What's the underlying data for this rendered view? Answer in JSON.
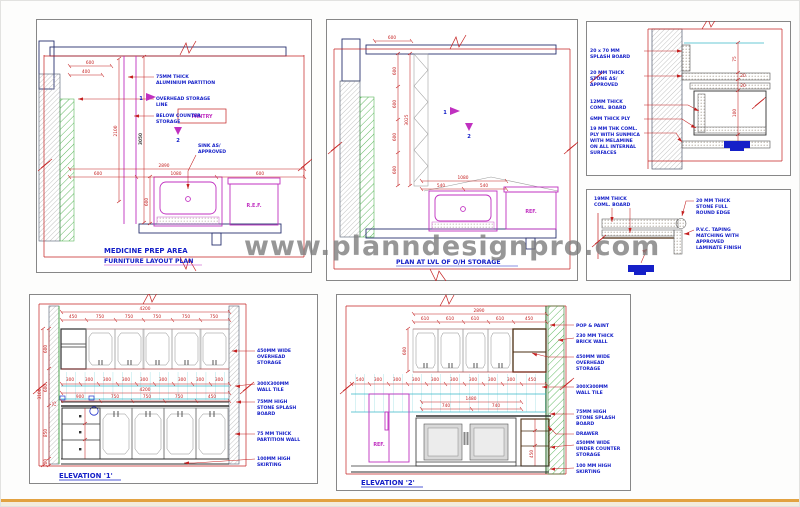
{
  "watermark": "www.planndesignpro.com",
  "plan1": {
    "title1": "MEDICINE PREP AREA",
    "title2": "FURNITURE LAYOUT PLAN",
    "room": "PANTRY",
    "ref": "R.E.F.",
    "sink_note": [
      "SINK AS/",
      "APPROVED"
    ],
    "ann": [
      [
        "75MM THICK",
        "ALUMINIUM PARTITION"
      ],
      [
        "OVERHEAD STORAGE",
        "LINE"
      ],
      [
        "BELOW COUNTER",
        "STORAGE"
      ]
    ],
    "markers": [
      "1",
      "2"
    ],
    "dims": {
      "a": "600",
      "b": "400",
      "v1": "2100",
      "v2": "3050",
      "total": "2890",
      "s1": "600",
      "s2": "1080",
      "s3": "600",
      "v3": "600"
    }
  },
  "plan2": {
    "title": "PLAN AT LVL OF O/H STORAGE",
    "ref": "REF.",
    "markers": [
      "1",
      "2"
    ],
    "dims": {
      "top": "600",
      "vtotal": "3025",
      "vseg": [
        "600",
        "600",
        "600",
        "600"
      ],
      "wtotal": "1080",
      "w1": "540",
      "w2": "540"
    }
  },
  "detail1": {
    "ann": [
      [
        "20 x 70 MM",
        "SPLASH BOARD"
      ],
      [
        "20 MM THICK",
        "STONE AS/",
        "APPROVED"
      ],
      [
        "12MM THICK",
        "COML. BOARD"
      ],
      [
        "6MM THICK PLY"
      ],
      [
        "19 MM THK COML.",
        "PLY WITH SUNMICA",
        "WITH MELAMINE",
        "ON ALL INTERNAL",
        "SURFACES"
      ]
    ],
    "dims": [
      "75",
      "20",
      "20",
      "100",
      "20"
    ]
  },
  "detail2": {
    "ann_left": [
      "19MM THICK",
      "COML. BOARD"
    ],
    "ann_right1": [
      "20 MM THICK",
      "STONE FULL",
      "ROUND EDGE"
    ],
    "ann_right2": [
      "P.V.C. TAPING",
      "MATCHING WITH",
      "APPROVED",
      "LAMINATE FINISH"
    ]
  },
  "elev1": {
    "title": "ELEVATION '1'",
    "ann": [
      [
        "450MM WIDE",
        "OVERHEAD",
        "STORAGE"
      ],
      [
        "300X300MM",
        "WALL TILE"
      ],
      [
        "75MM HIGH",
        "STONE SPLASH",
        "BOARD"
      ],
      [
        "75 MM THICK",
        "PARTITION WALL"
      ],
      [
        "100MM HIGH",
        "SKIRTING"
      ]
    ],
    "top_total": "4200",
    "top_segs": [
      "450",
      "750",
      "750",
      "750",
      "750",
      "750"
    ],
    "tile_dims": [
      "300",
      "300",
      "300",
      "300",
      "300",
      "300",
      "300",
      "300",
      "300"
    ],
    "mid_total": "4200",
    "counter_segs": [
      "900",
      "750",
      "750",
      "750",
      "450"
    ],
    "left_total": "3100",
    "left_segs": [
      "600",
      "600",
      "850",
      "100"
    ],
    "splash_dim": "75"
  },
  "elev2": {
    "title": "ELEVATION '2'",
    "ref": "REF.",
    "ann": [
      [
        "POP & PAINT"
      ],
      [
        "230 MM THICK",
        "BRICK WALL"
      ],
      [
        "450MM WIDE",
        "OVERHEAD",
        "STORAGE"
      ],
      [
        "300X300MM",
        "WALL TILE"
      ],
      [
        "75MM HIGH",
        "STONE SPLASH",
        "BOARD"
      ],
      [
        "DRAWER"
      ],
      [
        "450MM WIDE",
        "UNDER COUNTER",
        "STORAGE"
      ],
      [
        "100 MM HIGH",
        "SKIRTING"
      ]
    ],
    "top_total": "2890",
    "top_segs": [
      "610",
      "610",
      "610",
      "610",
      "450"
    ],
    "cab_height": "600",
    "tile_dims": [
      "540",
      "300",
      "300",
      "300",
      "300",
      "300",
      "300",
      "300",
      "300",
      "450"
    ],
    "sink_total": "1480",
    "sink_segs": [
      "740",
      "740"
    ],
    "unit_dim": "450"
  }
}
